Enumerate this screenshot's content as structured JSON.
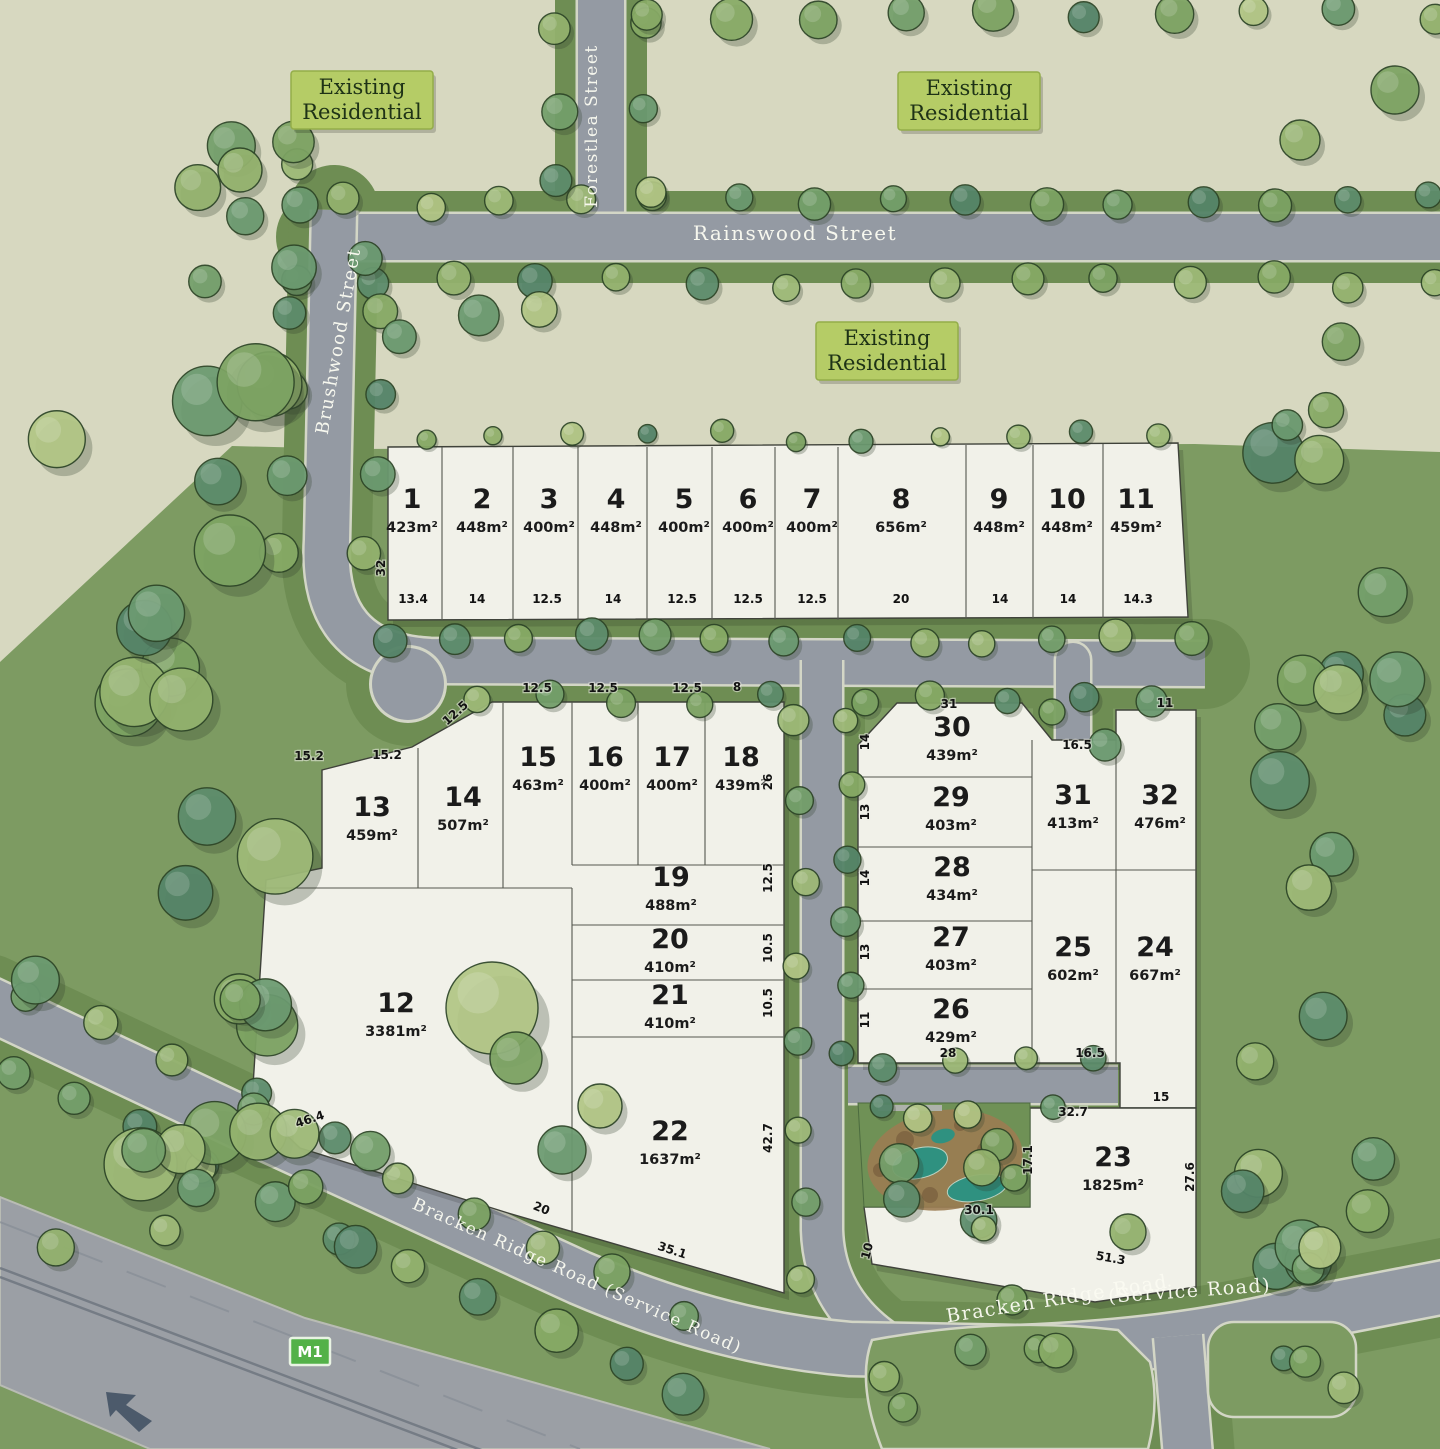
{
  "plan_title": "Residential estate subdivision plan",
  "legend": {
    "existing_residential_lines": [
      "Existing",
      "Residential"
    ]
  },
  "street_labels": [
    {
      "text": "Forestlea Street",
      "x": 597,
      "y": 126,
      "r": -90,
      "size": 17
    },
    {
      "text": "Rainswood Street",
      "x": 795,
      "y": 240,
      "r": 0,
      "size": 20
    },
    {
      "text": "Brushwood Street",
      "x": 344,
      "y": 342,
      "r": -80,
      "size": 18
    },
    {
      "text": "Bracken Ridge Road (Service Road)",
      "x": 575,
      "y": 1281,
      "r": 24,
      "size": 17
    },
    {
      "text": "Bracken Ridge Road",
      "x": 1058,
      "y": 1305,
      "r": -9,
      "size": 19
    },
    {
      "text": "(Service Road)",
      "x": 1190,
      "y": 1297,
      "r": -4,
      "size": 19
    }
  ],
  "motorway_badge": "M1",
  "area_boxes": [
    {
      "x": 362,
      "y": 100
    },
    {
      "x": 969,
      "y": 101
    },
    {
      "x": 887,
      "y": 351
    }
  ],
  "lots": [
    {
      "n": "1",
      "a": "423m²",
      "x": 412,
      "y": 508
    },
    {
      "n": "2",
      "a": "448m²",
      "x": 482,
      "y": 508
    },
    {
      "n": "3",
      "a": "400m²",
      "x": 549,
      "y": 508
    },
    {
      "n": "4",
      "a": "448m²",
      "x": 616,
      "y": 508
    },
    {
      "n": "5",
      "a": "400m²",
      "x": 684,
      "y": 508
    },
    {
      "n": "6",
      "a": "400m²",
      "x": 748,
      "y": 508
    },
    {
      "n": "7",
      "a": "400m²",
      "x": 812,
      "y": 508
    },
    {
      "n": "8",
      "a": "656m²",
      "x": 901,
      "y": 508
    },
    {
      "n": "9",
      "a": "448m²",
      "x": 999,
      "y": 508
    },
    {
      "n": "10",
      "a": "448m²",
      "x": 1067,
      "y": 508
    },
    {
      "n": "11",
      "a": "459m²",
      "x": 1136,
      "y": 508
    },
    {
      "n": "12",
      "a": "3381m²",
      "x": 396,
      "y": 1012
    },
    {
      "n": "13",
      "a": "459m²",
      "x": 372,
      "y": 816
    },
    {
      "n": "14",
      "a": "507m²",
      "x": 463,
      "y": 806
    },
    {
      "n": "15",
      "a": "463m²",
      "x": 538,
      "y": 766
    },
    {
      "n": "16",
      "a": "400m²",
      "x": 605,
      "y": 766
    },
    {
      "n": "17",
      "a": "400m²",
      "x": 672,
      "y": 766
    },
    {
      "n": "18",
      "a": "439m²",
      "x": 741,
      "y": 766
    },
    {
      "n": "19",
      "a": "488m²",
      "x": 671,
      "y": 886
    },
    {
      "n": "20",
      "a": "410m²",
      "x": 670,
      "y": 948
    },
    {
      "n": "21",
      "a": "410m²",
      "x": 670,
      "y": 1004
    },
    {
      "n": "22",
      "a": "1637m²",
      "x": 670,
      "y": 1140
    },
    {
      "n": "23",
      "a": "1825m²",
      "x": 1113,
      "y": 1166
    },
    {
      "n": "24",
      "a": "667m²",
      "x": 1155,
      "y": 956
    },
    {
      "n": "25",
      "a": "602m²",
      "x": 1073,
      "y": 956
    },
    {
      "n": "26",
      "a": "429m²",
      "x": 951,
      "y": 1018
    },
    {
      "n": "27",
      "a": "403m²",
      "x": 951,
      "y": 946
    },
    {
      "n": "28",
      "a": "434m²",
      "x": 952,
      "y": 876
    },
    {
      "n": "29",
      "a": "403m²",
      "x": 951,
      "y": 806
    },
    {
      "n": "30",
      "a": "439m²",
      "x": 952,
      "y": 736
    },
    {
      "n": "31",
      "a": "413m²",
      "x": 1073,
      "y": 804
    },
    {
      "n": "32",
      "a": "476m²",
      "x": 1160,
      "y": 804
    }
  ],
  "dims": [
    {
      "t": "13.4",
      "x": 413,
      "y": 603
    },
    {
      "t": "14",
      "x": 477,
      "y": 603
    },
    {
      "t": "12.5",
      "x": 547,
      "y": 603
    },
    {
      "t": "14",
      "x": 613,
      "y": 603
    },
    {
      "t": "12.5",
      "x": 682,
      "y": 603
    },
    {
      "t": "12.5",
      "x": 748,
      "y": 603
    },
    {
      "t": "12.5",
      "x": 812,
      "y": 603
    },
    {
      "t": "20",
      "x": 901,
      "y": 603
    },
    {
      "t": "14",
      "x": 1000,
      "y": 603
    },
    {
      "t": "14",
      "x": 1068,
      "y": 603
    },
    {
      "t": "14.3",
      "x": 1138,
      "y": 603
    },
    {
      "t": "32",
      "x": 385,
      "y": 568,
      "r": -90
    },
    {
      "t": "12.5",
      "x": 537,
      "y": 692
    },
    {
      "t": "12.5",
      "x": 603,
      "y": 692
    },
    {
      "t": "12.5",
      "x": 687,
      "y": 692
    },
    {
      "t": "8",
      "x": 737,
      "y": 691
    },
    {
      "t": "12.5",
      "x": 458,
      "y": 716,
      "r": -42
    },
    {
      "t": "15.2",
      "x": 309,
      "y": 760
    },
    {
      "t": "15.2",
      "x": 387,
      "y": 759
    },
    {
      "t": "26",
      "x": 772,
      "y": 782,
      "r": -90
    },
    {
      "t": "12.5",
      "x": 772,
      "y": 878,
      "r": -90
    },
    {
      "t": "10.5",
      "x": 772,
      "y": 948,
      "r": -90
    },
    {
      "t": "10.5",
      "x": 772,
      "y": 1003,
      "r": -90
    },
    {
      "t": "42.7",
      "x": 772,
      "y": 1138,
      "r": -90
    },
    {
      "t": "46.4",
      "x": 311,
      "y": 1123,
      "r": -18
    },
    {
      "t": "20",
      "x": 540,
      "y": 1212,
      "r": 22
    },
    {
      "t": "35.1",
      "x": 671,
      "y": 1254,
      "r": 18
    },
    {
      "t": "14",
      "x": 869,
      "y": 742,
      "r": -90
    },
    {
      "t": "13",
      "x": 869,
      "y": 812,
      "r": -90
    },
    {
      "t": "14",
      "x": 869,
      "y": 878,
      "r": -90
    },
    {
      "t": "13",
      "x": 869,
      "y": 952,
      "r": -90
    },
    {
      "t": "11",
      "x": 869,
      "y": 1020,
      "r": -90
    },
    {
      "t": "31",
      "x": 949,
      "y": 708
    },
    {
      "t": "16.5",
      "x": 1077,
      "y": 749
    },
    {
      "t": "11",
      "x": 1165,
      "y": 707
    },
    {
      "t": "28",
      "x": 948,
      "y": 1057
    },
    {
      "t": "16.5",
      "x": 1090,
      "y": 1057
    },
    {
      "t": "15",
      "x": 1161,
      "y": 1101
    },
    {
      "t": "32.7",
      "x": 1073,
      "y": 1116
    },
    {
      "t": "17.1",
      "x": 1032,
      "y": 1160,
      "r": -90
    },
    {
      "t": "30.1",
      "x": 979,
      "y": 1214
    },
    {
      "t": "10",
      "x": 871,
      "y": 1252,
      "r": -75
    },
    {
      "t": "51.3",
      "x": 1110,
      "y": 1262,
      "r": 10
    },
    {
      "t": "27.6",
      "x": 1194,
      "y": 1177,
      "r": -90
    }
  ],
  "colors": {
    "base_green": "#7d9b62",
    "beige": "#d7d8c0",
    "road": "#949aa3",
    "motorway": "#9b9fa5",
    "casing": "#d3d6c6",
    "verge": "#6e8d53",
    "lot_fill": "#f1f1e9",
    "lot_line": "#3f423a",
    "label_box": "#b5cc66",
    "label_box_border": "#93ad49",
    "label_text": "#1e3216",
    "street_text": "#fbfbf2",
    "dim_text": "#121212",
    "m1_green": "#53b148",
    "pond": "#2f9180",
    "mulch": "#9b7c52",
    "park": "#6f9156"
  }
}
